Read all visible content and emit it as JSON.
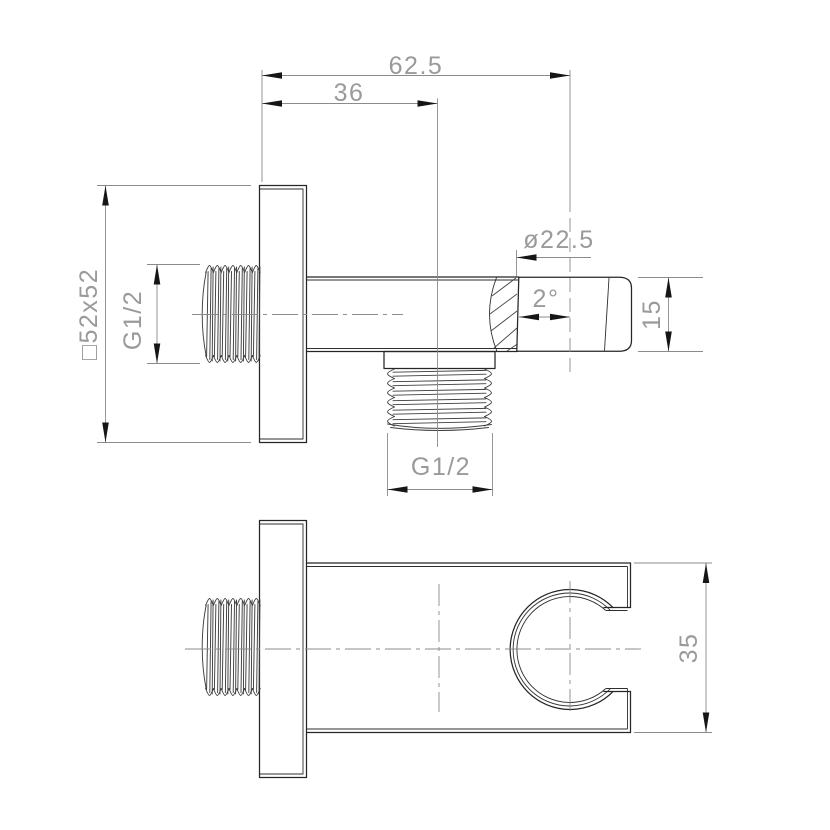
{
  "drawing": {
    "title": "Shower holder wall elbow - dimensioned technical drawing",
    "colors": {
      "background": "#ffffff",
      "outline": "#262626",
      "thread_line": "#3f3f3f",
      "dim_line": "#8b8b8b",
      "dim_text": "#9a9a9a",
      "arrowhead": "#161616"
    },
    "dimensions": {
      "overall_depth": "62.5",
      "wall_plate_offset": "36",
      "wall_plate_size": "□52x52",
      "inlet_thread": "G1/2",
      "outlet_thread": "G1/2",
      "holder_cone_diameter": "ø22.5",
      "holder_cone_angle": "2°",
      "holder_cone_height": "15",
      "bracket_height": "35"
    }
  }
}
